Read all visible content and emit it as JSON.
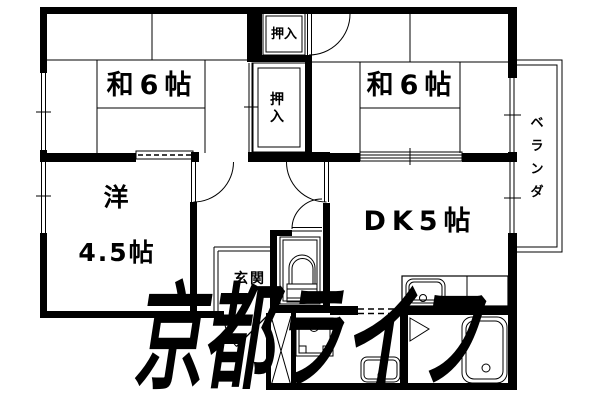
{
  "floorplan": {
    "title": "apartment-floor-plan",
    "rooms": {
      "japanese_room_left": {
        "label": "和6帖"
      },
      "japanese_room_right": {
        "label": "和6帖"
      },
      "western_room": {
        "label_line1": "洋",
        "label_line2": "4.5帖"
      },
      "dining_kitchen": {
        "label": "DK5帖"
      },
      "entrance": {
        "label": "玄関"
      },
      "closet_upper": {
        "label": "押入"
      },
      "closet_lower": {
        "chars": [
          "押",
          "入"
        ]
      },
      "veranda": {
        "label": "ベランダ",
        "chars": [
          "ベ",
          "ラ",
          "ン",
          "ダ"
        ]
      }
    },
    "watermark": {
      "text": "京都ライフ",
      "color": "#b5b5b5"
    },
    "colors": {
      "wall": "#000000",
      "background": "#ffffff",
      "watermark": "#b5b5b5"
    }
  }
}
